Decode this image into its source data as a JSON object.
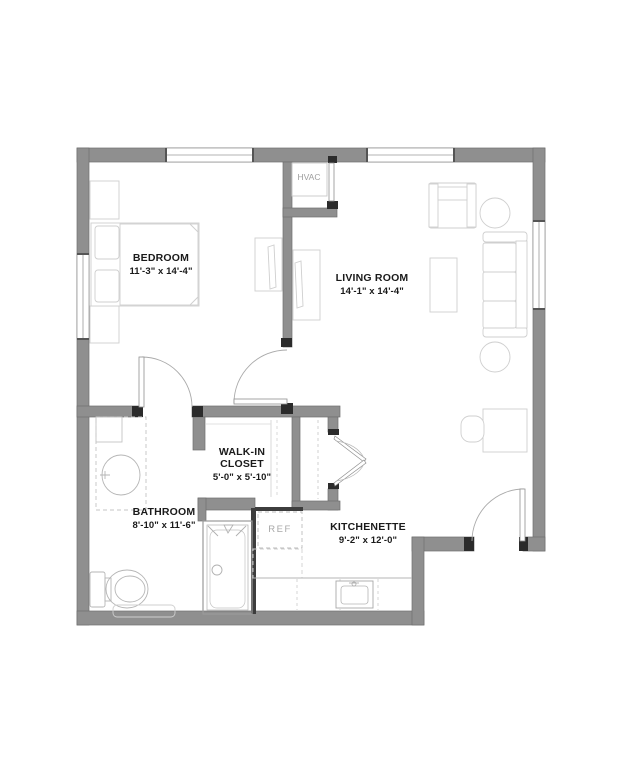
{
  "plan": {
    "bedroom": {
      "name": "BEDROOM",
      "dims": "11'-3\" x 14'-4\""
    },
    "living_room": {
      "name": "LIVING ROOM",
      "dims": "14'-1\" x 14'-4\""
    },
    "walk_in_closet": {
      "name": "WALK-IN CLOSET",
      "dims": "5'-0\" x 5'-10\""
    },
    "bathroom": {
      "name": "BATHROOM",
      "dims": "8'-10\" x 11'-6\""
    },
    "kitchenette": {
      "name": "KITCHENETTE",
      "dims": "9'-2\" x 12'-0\""
    },
    "hvac_label": "HVAC",
    "ref_label": "REF"
  },
  "colors": {
    "background": "#ffffff",
    "wall_fill": "#8f8f8f",
    "wall_edge": "#6e6e6e",
    "jamb_black": "#2b2b2b",
    "furniture_line": "#cfcfcf",
    "fixture_line": "#a8a8a8",
    "label_text": "#1a1a1a",
    "utility_text": "#9e9e9e"
  }
}
